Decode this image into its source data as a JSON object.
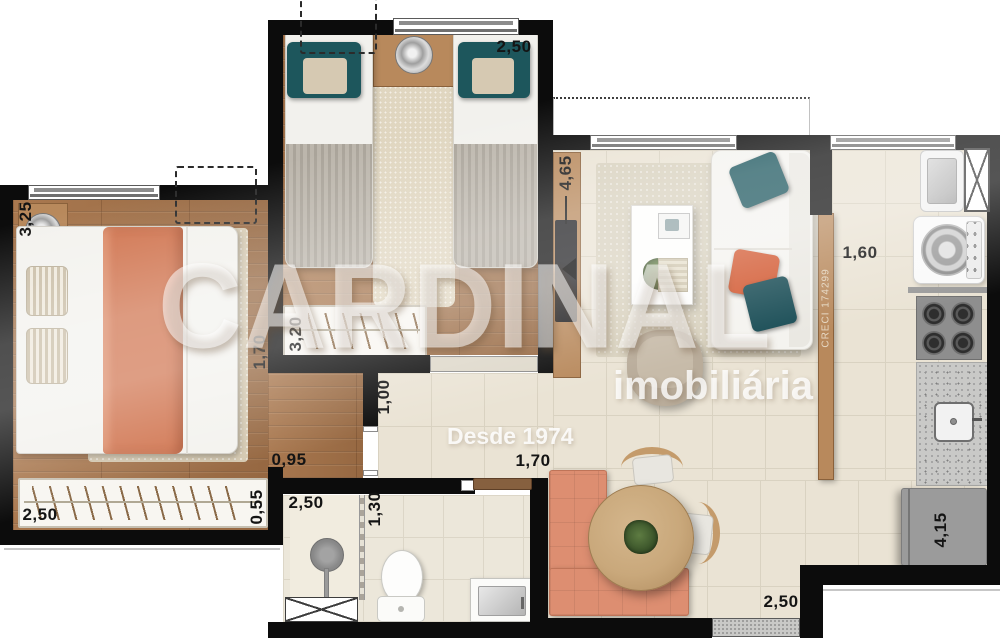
{
  "watermark": {
    "brand": "CARDINAL",
    "subtitle": "imobiliária",
    "tagline": "Desde 1974",
    "creci": "CRECI 174299"
  },
  "dimensions": {
    "bedroom1_side": "3,25",
    "bedroom2_top": "2,50",
    "living_side": "4,65",
    "kitchen_width": "1,60",
    "bedroom1_right": "1,70",
    "bedroom2_wardrobe": "3,20",
    "hall_width": "1,00",
    "bedroom1_passage": "0,95",
    "hall_length": "1,70",
    "bathroom_width": "2,50",
    "shower_width": "1,30",
    "bedroom1_wardrobe": "2,50",
    "bedroom1_wardrobe_depth": "0,55",
    "dining_bottom": "2,50",
    "kitchen_side": "4,15"
  },
  "colors": {
    "wall": "#0c0c0c",
    "wood_floor": "#a0714a",
    "tile_floor": "#eae3d4",
    "accent_orange": "#d0744f",
    "accent_teal": "#1d565c",
    "sofa_white": "#f4f3ef",
    "appliance_gray": "#9b9b9b"
  }
}
